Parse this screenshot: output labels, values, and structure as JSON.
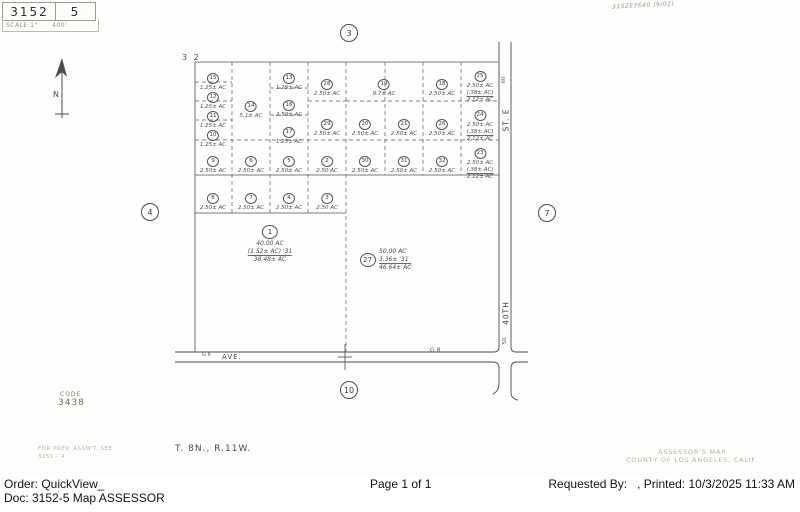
{
  "header": {
    "book": "3152",
    "page": "5",
    "scale_label": "SCALE 1\"      400'",
    "handwritten_ref": "3152E7640 (9/01)"
  },
  "compass": {
    "label": "N"
  },
  "map": {
    "section_label": "3 2",
    "streets": {
      "right_upper": "ST. E",
      "right_lower": "40TH",
      "upper_width": "60",
      "lower_width": "50",
      "avenue": "AVE.",
      "avenue_small_left": "G 8",
      "avenue_small_right": "G 8"
    },
    "ref_circles": [
      {
        "label": "3",
        "x": 349,
        "y": 33
      },
      {
        "label": "4",
        "x": 150,
        "y": 212
      },
      {
        "label": "7",
        "x": 547,
        "y": 213
      },
      {
        "label": "10",
        "x": 349,
        "y": 390
      }
    ],
    "parcels": [
      {
        "num": "15",
        "x": 213,
        "y": 66,
        "lines": [
          "1.25± AC"
        ]
      },
      {
        "num": "12",
        "x": 213,
        "y": 85,
        "lines": [
          "1.25± AC"
        ]
      },
      {
        "num": "11",
        "x": 213,
        "y": 104,
        "lines": [
          "1.25± AC"
        ]
      },
      {
        "num": "10",
        "x": 213,
        "y": 123,
        "lines": [
          "1.25± AC"
        ]
      },
      {
        "num": "14",
        "x": 251,
        "y": 94,
        "lines": [
          "5.1± AC"
        ]
      },
      {
        "num": "13",
        "x": 289,
        "y": 66,
        "lines": [
          "1.25± AC"
        ]
      },
      {
        "num": "16",
        "x": 289,
        "y": 93,
        "lines": [
          "2.50± AC"
        ]
      },
      {
        "num": "17",
        "x": 289,
        "y": 120,
        "lines": [
          "1.25± AC"
        ]
      },
      {
        "num": "28",
        "x": 327,
        "y": 72,
        "lines": [
          "2.50± AC"
        ]
      },
      {
        "num": "29",
        "x": 327,
        "y": 112,
        "lines": [
          "2.50± AC"
        ]
      },
      {
        "num": "19",
        "x": 384,
        "y": 72,
        "lines": [
          "9.7± AC"
        ]
      },
      {
        "num": "18",
        "x": 442,
        "y": 72,
        "lines": [
          "2.50± AC"
        ]
      },
      {
        "num": "25",
        "x": 480,
        "y": 64,
        "lines": [
          "2.50± AC",
          "(.38± AC)",
          "2.12± AC"
        ]
      },
      {
        "num": "20",
        "x": 365,
        "y": 112,
        "lines": [
          "2.50± AC"
        ]
      },
      {
        "num": "21",
        "x": 404,
        "y": 112,
        "lines": [
          "2.50± AC"
        ]
      },
      {
        "num": "26",
        "x": 442,
        "y": 112,
        "lines": [
          "2.50± AC"
        ]
      },
      {
        "num": "24",
        "x": 480,
        "y": 103,
        "lines": [
          "2.50± AC",
          "(.38± AC)",
          "2.12± AC"
        ]
      },
      {
        "num": "9",
        "x": 213,
        "y": 149,
        "lines": [
          "2.50± AC"
        ]
      },
      {
        "num": "6",
        "x": 251,
        "y": 149,
        "lines": [
          "2.50± AC"
        ]
      },
      {
        "num": "5",
        "x": 289,
        "y": 149,
        "lines": [
          "2.50± AC"
        ]
      },
      {
        "num": "2",
        "x": 327,
        "y": 149,
        "lines": [
          "2.50 AC"
        ]
      },
      {
        "num": "30",
        "x": 365,
        "y": 149,
        "lines": [
          "2.50± AC"
        ]
      },
      {
        "num": "31",
        "x": 404,
        "y": 149,
        "lines": [
          "2.50± AC"
        ]
      },
      {
        "num": "32",
        "x": 442,
        "y": 149,
        "lines": [
          "2.50± AC"
        ]
      },
      {
        "num": "23",
        "x": 480,
        "y": 141,
        "lines": [
          "2.50± AC",
          "(.38± AC)",
          "2.12± AC"
        ]
      },
      {
        "num": "8",
        "x": 213,
        "y": 186,
        "lines": [
          "2.50± AC"
        ]
      },
      {
        "num": "7",
        "x": 251,
        "y": 186,
        "lines": [
          "2.50± AC"
        ]
      },
      {
        "num": "4",
        "x": 289,
        "y": 186,
        "lines": [
          "2.50± AC"
        ]
      },
      {
        "num": "3",
        "x": 327,
        "y": 186,
        "lines": [
          "2.50 AC"
        ]
      },
      {
        "num": "1",
        "x": 270,
        "y": 221,
        "big": true,
        "lines": [
          "40.00 AC",
          "(1.52± AC) '31",
          "38.48± AC"
        ]
      },
      {
        "num": "27",
        "x": 360,
        "y": 248,
        "big": true,
        "side": true,
        "lines": [
          "50.00 AC",
          "3.36± '31",
          "46.64± AC"
        ]
      }
    ]
  },
  "notes": {
    "code_label": "CODE",
    "code_value": "3438",
    "prev_assmt_1": "FOR PREV. ASSM'T. SEE",
    "prev_assmt_2": "3151 - 4",
    "township": "T. 8N., R.11W.",
    "assessors_map": "ASSESSOR'S MAP",
    "county": "COUNTY OF LOS ANGELES, CALIF."
  },
  "footer": {
    "order": "Order: QuickView_",
    "doc": "Doc: 3152-5 Map ASSESSOR",
    "page": "Page 1 of 1",
    "requested": "Requested By:   , Printed: 10/3/2025 11:33 AM"
  }
}
